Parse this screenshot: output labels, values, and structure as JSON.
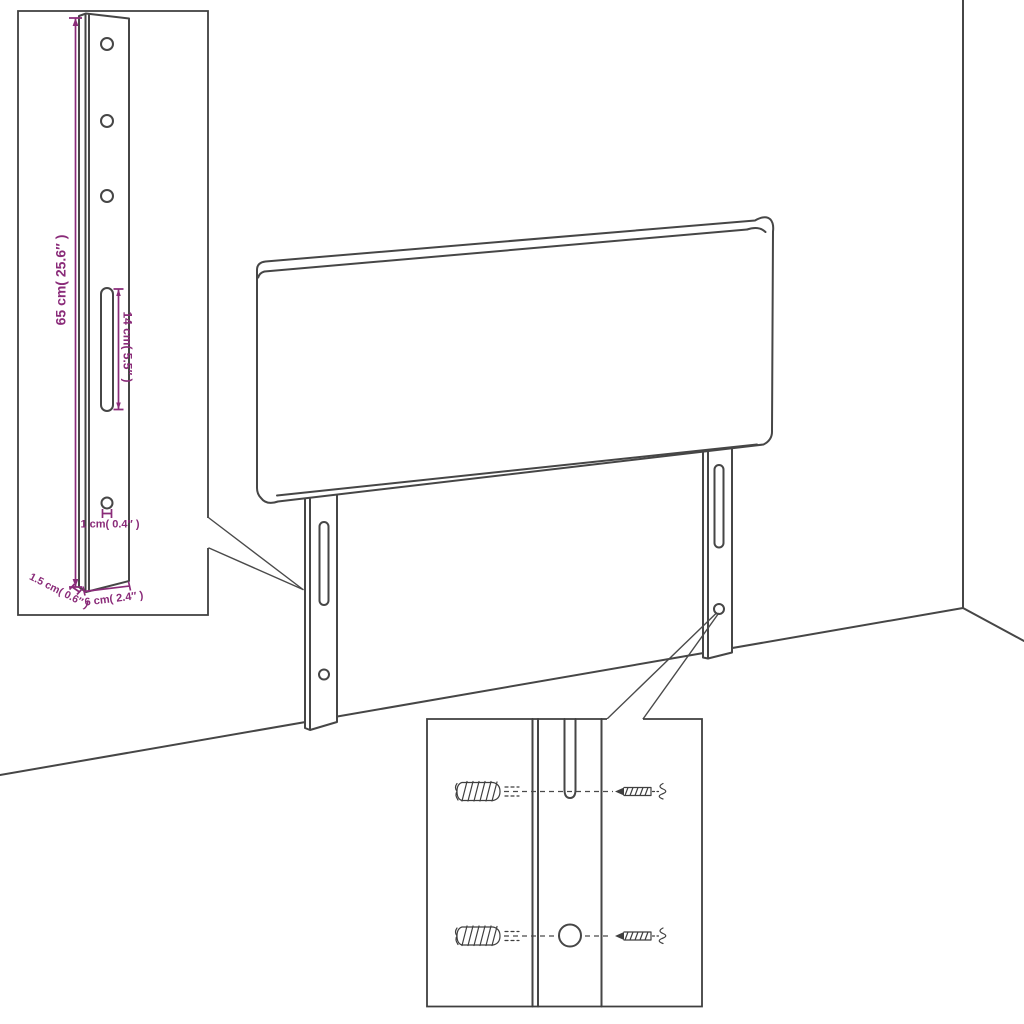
{
  "diagram": {
    "type": "furniture-assembly-dimension-diagram",
    "subject": "headboard with two mounting legs shown against a room corner, with magnified leg detail and wall-mounting hardware detail"
  },
  "colors": {
    "dimension_accent": "#8a2b79",
    "line_art": "#464646",
    "background": "#ffffff"
  },
  "leg_detail_inset": {
    "height_dimension_label": "65 cm( 25.6″ )",
    "slot_dimension_label": "14 cm( 5.5″ )",
    "hole_dimension_label": "1 cm( 0.4″ )",
    "width_dimension_label": "6 cm( 2.4″ )",
    "thickness_dimension_label": "1.5 cm( 0.6″ )"
  }
}
